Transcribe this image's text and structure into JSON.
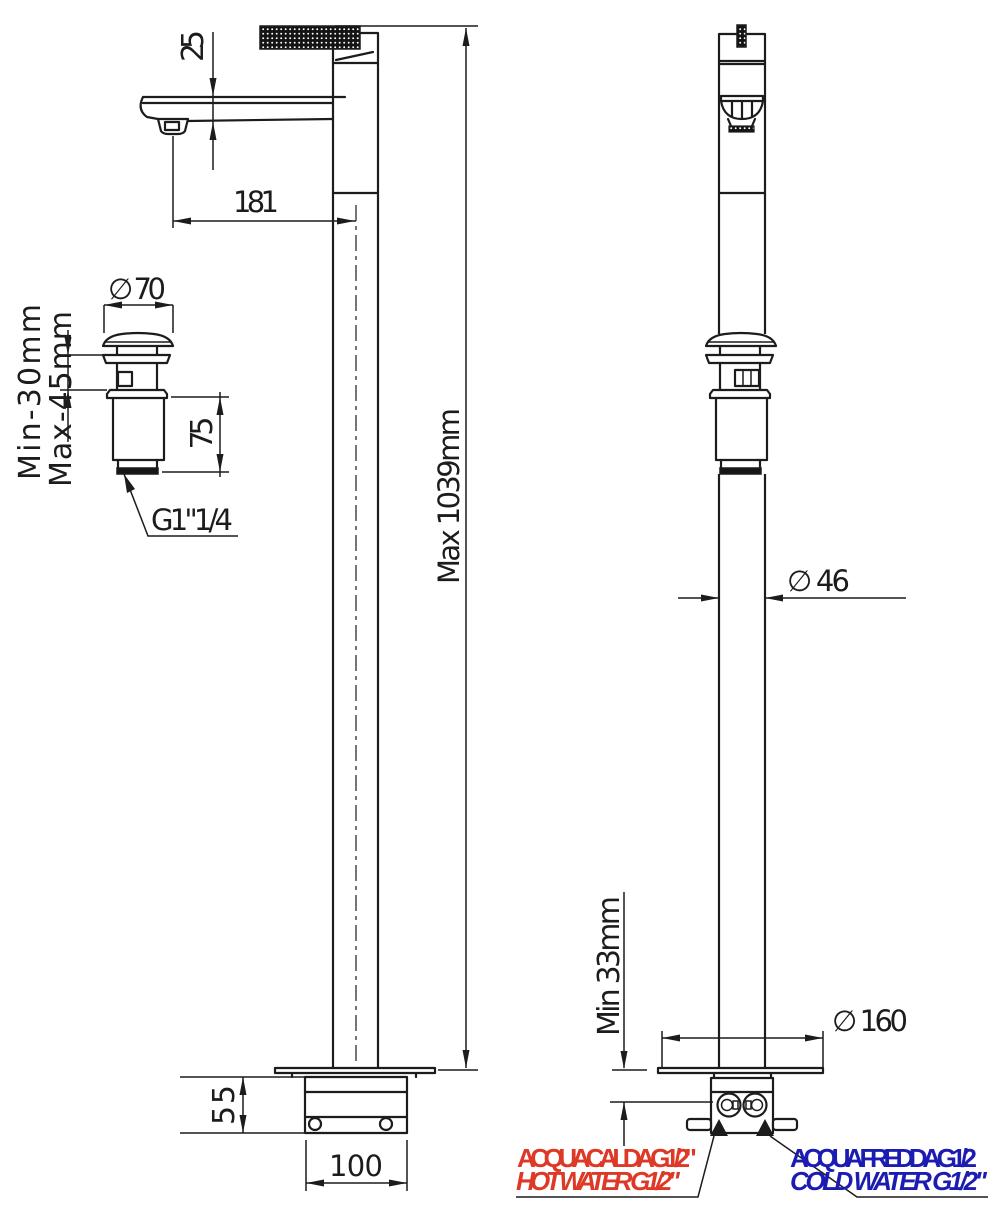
{
  "drawing": {
    "labels": {
      "spout_height": "25",
      "spout_reach": "181",
      "max_height": "Max 1039mm",
      "waste_cap_diameter": "∅ 70",
      "counter_min": "Min-30mm",
      "counter_max": "Max-45mm",
      "waste_tail_length": "75",
      "waste_thread": "G1\"1/4",
      "column_diameter": "∅ 46",
      "inlet_clearance": "Min 33mm",
      "base_plate_diameter": "∅ 160",
      "base_height": "55",
      "base_width": "100"
    },
    "connections": {
      "hot_it": "ACQUA CALDA G1/2\"",
      "hot_en": "HOT WATER G1/2\"",
      "cold_it": "ACQUA FREDDA G1/2",
      "cold_en": "COLD WATER G1/2\""
    },
    "colors": {
      "line": "#1c1c1c",
      "hot": "#de3826",
      "cold": "#1c1cb2",
      "background": "#ffffff"
    }
  }
}
